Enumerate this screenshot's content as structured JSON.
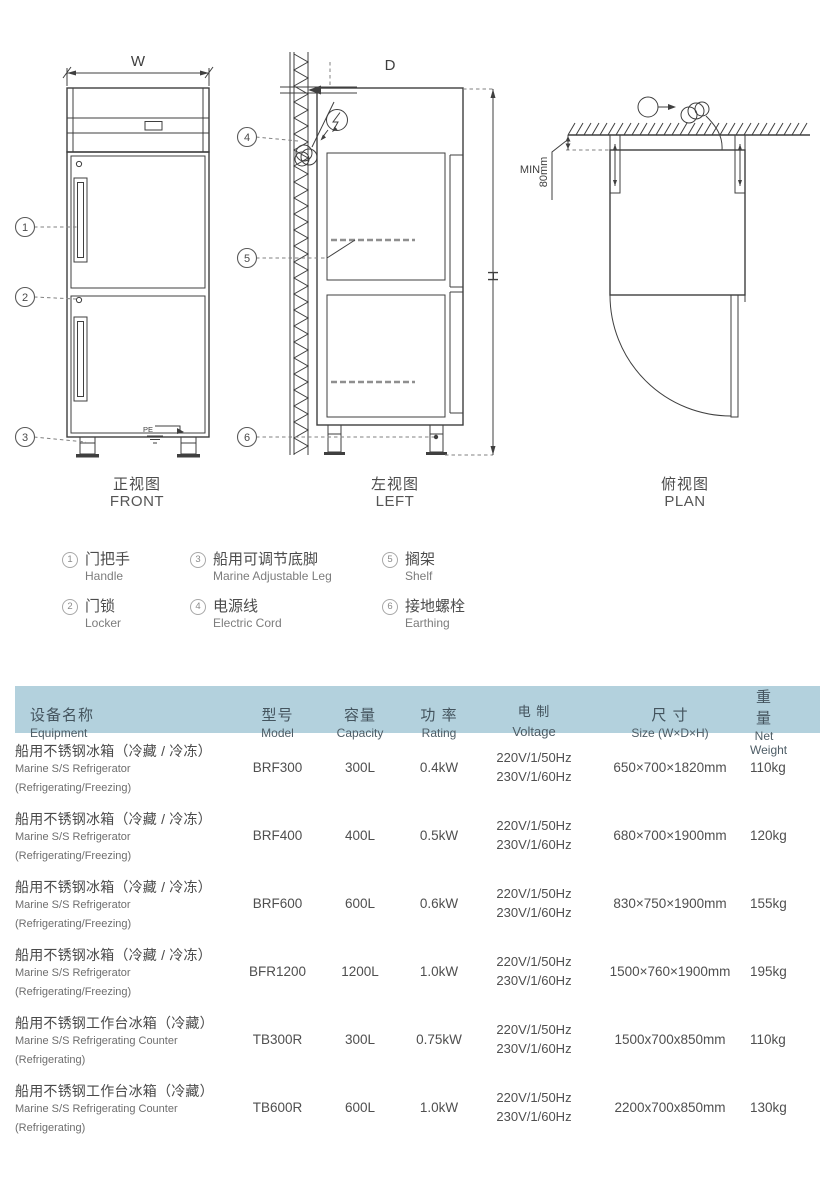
{
  "colors": {
    "header_bg": "#b3d1dd",
    "line": "#3f3f3f",
    "text": "#4a4a4a"
  },
  "callouts": [
    "1",
    "2",
    "3",
    "4",
    "5",
    "6"
  ],
  "views": {
    "front": {
      "label_cn": "正视图",
      "label_en": "FRONT",
      "dim_w": "W",
      "pe_label": "PE"
    },
    "left": {
      "label_cn": "左视图",
      "label_en": "LEFT",
      "dim_d": "D",
      "dim_h": "H"
    },
    "plan": {
      "label_cn": "俯视图",
      "label_en": "PLAN",
      "min_label": "MIN",
      "gap_label": "80mm"
    }
  },
  "legend": {
    "items": [
      {
        "num": "1",
        "cn": "门把手",
        "en": "Handle"
      },
      {
        "num": "2",
        "cn": "门锁",
        "en": "Locker"
      },
      {
        "num": "3",
        "cn": "船用可调节底脚",
        "en": "Marine Adjustable Leg"
      },
      {
        "num": "4",
        "cn": "电源线",
        "en": "Electric Cord"
      },
      {
        "num": "5",
        "cn": "搁架",
        "en": "Shelf"
      },
      {
        "num": "6",
        "cn": "接地螺栓",
        "en": "Earthing"
      }
    ]
  },
  "table": {
    "header": {
      "equipment_cn": "设备名称",
      "equipment_en": "Equipment",
      "model_cn": "型号",
      "model_en": "Model",
      "capacity_cn": "容量",
      "capacity_en": "Capacity",
      "rating_cn": "功 率",
      "rating_en": "Rating",
      "voltage_cn": "电 制",
      "voltage_en": "Voltage",
      "size_cn": "尺 寸",
      "size_en": "Size (W×D×H)",
      "weight_cn": "重 量",
      "weight_en": "Net Weight"
    },
    "rows": [
      {
        "name_cn": "船用不锈钢冰箱（冷藏 / 冷冻）",
        "name_en": "Marine S/S Refrigerator",
        "name_sub": "(Refrigerating/Freezing)",
        "model": "BRF300",
        "capacity": "300L",
        "rating": "0.4kW",
        "voltage1": "220V/1/50Hz",
        "voltage2": "230V/1/60Hz",
        "size": "650×700×1820mm",
        "weight": "110kg"
      },
      {
        "name_cn": "船用不锈钢冰箱（冷藏 / 冷冻）",
        "name_en": "Marine S/S Refrigerator",
        "name_sub": "(Refrigerating/Freezing)",
        "model": "BRF400",
        "capacity": "400L",
        "rating": "0.5kW",
        "voltage1": "220V/1/50Hz",
        "voltage2": "230V/1/60Hz",
        "size": "680×700×1900mm",
        "weight": "120kg"
      },
      {
        "name_cn": "船用不锈钢冰箱（冷藏 / 冷冻）",
        "name_en": "Marine S/S Refrigerator",
        "name_sub": "(Refrigerating/Freezing)",
        "model": "BRF600",
        "capacity": "600L",
        "rating": "0.6kW",
        "voltage1": "220V/1/50Hz",
        "voltage2": "230V/1/60Hz",
        "size": "830×750×1900mm",
        "weight": "155kg"
      },
      {
        "name_cn": "船用不锈钢冰箱（冷藏 / 冷冻）",
        "name_en": "Marine S/S Refrigerator",
        "name_sub": "(Refrigerating/Freezing)",
        "model": "BFR1200",
        "capacity": "1200L",
        "rating": "1.0kW",
        "voltage1": "220V/1/50Hz",
        "voltage2": "230V/1/60Hz",
        "size": "1500×760×1900mm",
        "weight": "195kg"
      },
      {
        "name_cn": "船用不锈钢工作台冰箱（冷藏）",
        "name_en": "Marine S/S Refrigerating Counter",
        "name_sub": "(Refrigerating)",
        "model": "TB300R",
        "capacity": "300L",
        "rating": "0.75kW",
        "voltage1": "220V/1/50Hz",
        "voltage2": "230V/1/60Hz",
        "size": "1500x700x850mm",
        "weight": "110kg"
      },
      {
        "name_cn": "船用不锈钢工作台冰箱（冷藏）",
        "name_en": "Marine S/S Refrigerating Counter",
        "name_sub": "(Refrigerating)",
        "model": "TB600R",
        "capacity": "600L",
        "rating": "1.0kW",
        "voltage1": "220V/1/50Hz",
        "voltage2": "230V/1/60Hz",
        "size": "2200x700x850mm",
        "weight": "130kg"
      }
    ]
  }
}
